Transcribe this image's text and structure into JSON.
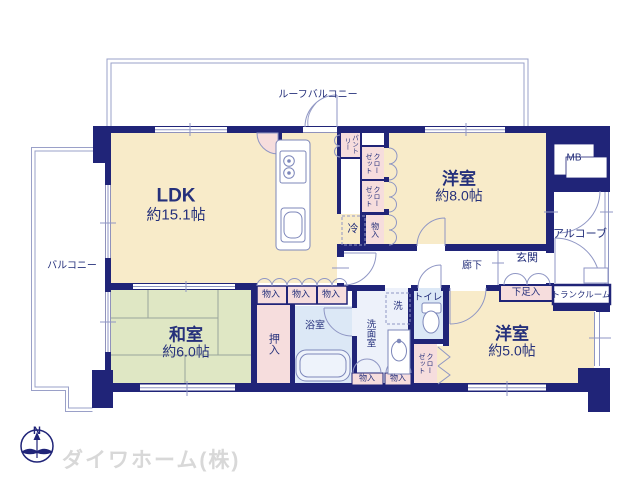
{
  "branding": {
    "company": "ダイワホーム(株)",
    "compass": "N"
  },
  "rooms": {
    "ldk": {
      "name": "LDK",
      "size": "約15.1帖"
    },
    "bedroom8": {
      "name": "洋室",
      "size": "約8.0帖"
    },
    "bedroom5": {
      "name": "洋室",
      "size": "約5.0帖"
    },
    "tatami": {
      "name": "和室",
      "size": "約6.0帖"
    }
  },
  "labels": {
    "roof_balcony": "ルーフバルコニー",
    "balcony": "バルコニー",
    "alcove": "アルコーブ",
    "entrance": "玄関",
    "hallway": "廊下",
    "meter_box": "MB",
    "trunk_room": "トランクルーム",
    "shoe_cabinet": "下足入",
    "toilet": "トイレ",
    "washroom": "洗面室",
    "bathroom": "浴室",
    "washer": "洗",
    "refrigerator": "冷",
    "pantry": "パントリー",
    "closet": "クローゼット",
    "futon_closet": "押入",
    "storage": "物入"
  },
  "colors": {
    "wall": "#202478",
    "room_floor": "#f8ebc9",
    "tatami_floor": "#dfe7c4",
    "closet_pink": "#f6dddd",
    "wet_area_blue": "#dce8f6",
    "washroom_floor": "#edf1fa",
    "text": "#25307b",
    "outline": "#8f96c4",
    "brand_text": "#d8d8d8"
  }
}
